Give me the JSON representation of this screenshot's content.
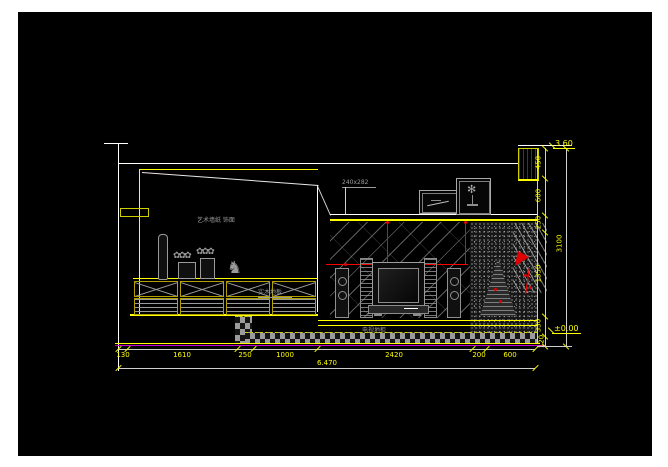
{
  "labels": {
    "wall_finish": "艺术墙纸 饰面",
    "picture_size": "240x282",
    "floor_finish": "实木地板",
    "cabinet": "电视地柜"
  },
  "dimensions": {
    "bottom": {
      "segments": [
        "130",
        "1610",
        "250",
        "1000",
        "2420",
        "200",
        "600"
      ],
      "total": "6.470"
    },
    "right": {
      "segments": [
        "450",
        "600",
        "250",
        "1350",
        "330",
        "120"
      ],
      "total": "3100"
    },
    "elevation_top": "3.60",
    "elevation_floor": "±0.00"
  },
  "colors": {
    "line": "#ffffff",
    "dimension": "#ffff00",
    "highlight": "#ff0000",
    "floor_line": "#cc00cc"
  },
  "decor": {
    "horse_figurine": "♞",
    "plant_flowers": "✿✿✿",
    "picture_plant": "✻"
  }
}
